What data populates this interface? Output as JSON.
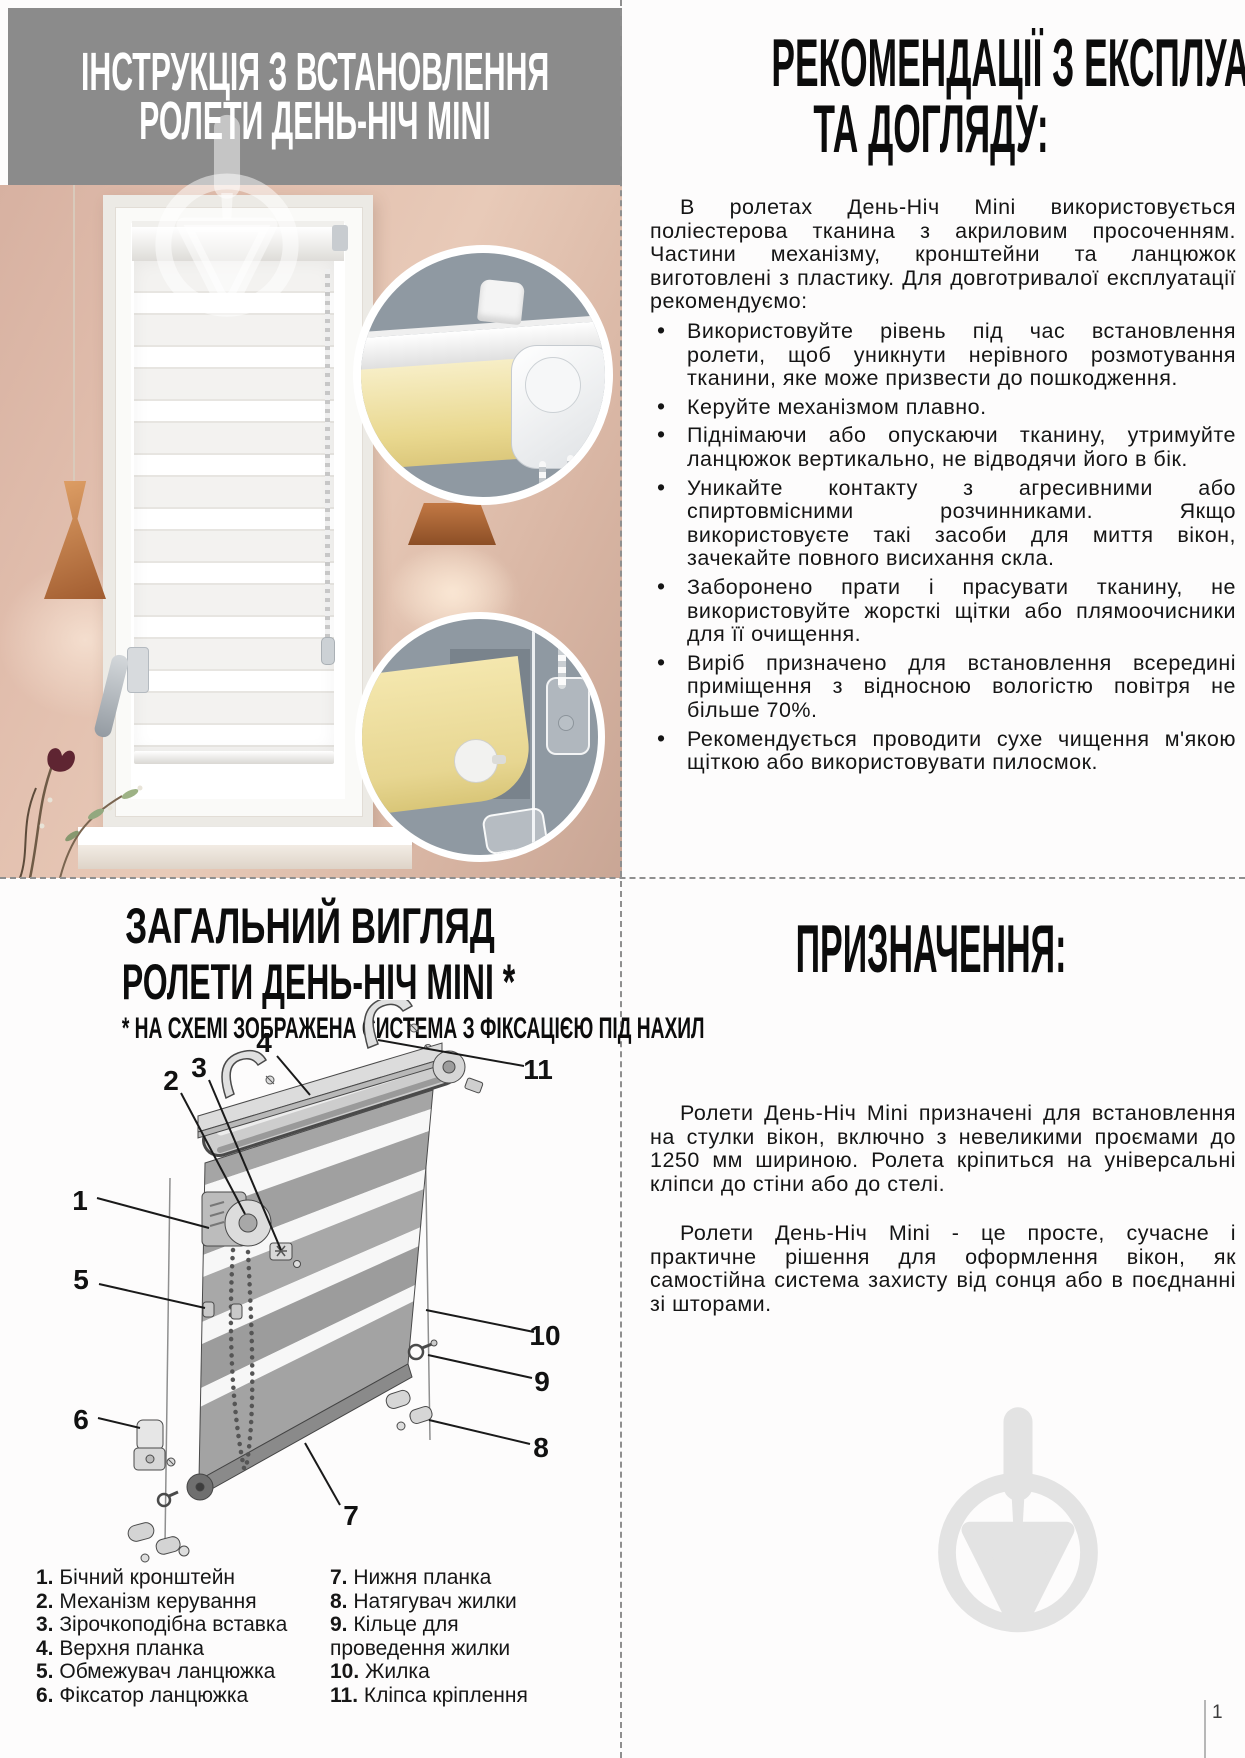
{
  "page": {
    "number": "1"
  },
  "colors": {
    "header_band": "#8b8b8b",
    "wall_pink": "#e0bcab",
    "copper_lamp": "#c27844",
    "fabric_yellow": "#eddfa3",
    "inset_background": "#8f99a2",
    "divider_gray": "#8f8f8f"
  },
  "install_title": {
    "line1": "ІНСТРУКЦІЯ З ВСТАНОВЛЕННЯ",
    "line2": "РОЛЕТИ ДЕНЬ-НІЧ MINI"
  },
  "recommendations": {
    "title_line1": "РЕКОМЕНДАЦІЇ З ЕКСПЛУАТАЦІЇ",
    "title_line2": "ТА ДОГЛЯДУ:",
    "intro": "В ролетах День-Ніч Mini використовується поліестерова тканина з акриловим просоченням. Частини механізму, кронштейни та ланцюжок виготовлені з пластику. Для довготривалої експлуатації рекомендуємо:",
    "bullets": [
      "Використовуйте рівень під час встановлення ролети, щоб уникнути нерівного розмотування тканини, яке може призвести до пошкодження.",
      "Керуйте механізмом плавно.",
      "Піднімаючи або опускаючи тканину, утримуйте ланцюжок вертикально, не відводячи його в бік.",
      "Уникайте контакту з агресивними або спиртовмісними розчинниками. Якщо використовуєте такі засоби для миття вікон, зачекайте повного висихання скла.",
      "Заборонено прати і прасувати тканину, не використовуйте жорсткі щітки або плямоочисники для її очищення.",
      "Виріб призначено для встановлення всередині приміщення з відносною вологістю повітря не більше 70%.",
      "Рекомендується проводити сухе чищення м'якою щіткою або використовувати пилосмок."
    ]
  },
  "overview": {
    "title_line1": "ЗАГАЛЬНИЙ ВИГЛЯД",
    "title_line2": "РОЛЕТИ ДЕНЬ-НІЧ MINI *",
    "subtitle": "* НА СХЕМІ ЗОБРАЖЕНА СИСТЕМА З ФІКСАЦІЄЮ ПІД НАХИЛ",
    "callouts": [
      "1",
      "2",
      "3",
      "4",
      "5",
      "6",
      "7",
      "8",
      "9",
      "10",
      "11"
    ],
    "legend_left": [
      {
        "num": "1.",
        "label": "Бічний кронштейн"
      },
      {
        "num": "2.",
        "label": "Механізм керування"
      },
      {
        "num": "3.",
        "label": "Зірочкоподібна вставка"
      },
      {
        "num": "4.",
        "label": "Верхня планка"
      },
      {
        "num": "5.",
        "label": "Обмежувач ланцюжка"
      },
      {
        "num": "6.",
        "label": "Фіксатор ланцюжка"
      }
    ],
    "legend_right": [
      {
        "num": "7.",
        "label": "Нижня планка"
      },
      {
        "num": "8.",
        "label": "Натягувач жилки"
      },
      {
        "num": "9.",
        "label": "Кільце для проведення жилки"
      },
      {
        "num": "10.",
        "label": "Жилка"
      },
      {
        "num": "11.",
        "label": "Кліпса кріплення"
      }
    ]
  },
  "purpose": {
    "title": "ПРИЗНАЧЕННЯ:",
    "p1": "Ролети День-Ніч Mini призначені для встановлення на стулки вікон, включно з невеликими проємами до 1250 мм шириною. Ролета кріпиться на універсальні кліпси до стіни або до стелі.",
    "p2": "Ролети День-Ніч Mini - це просте, сучасне і практичне рішення для оформлення вікон, як самостійна система захисту від сонця або в поєднанні зі шторами."
  }
}
